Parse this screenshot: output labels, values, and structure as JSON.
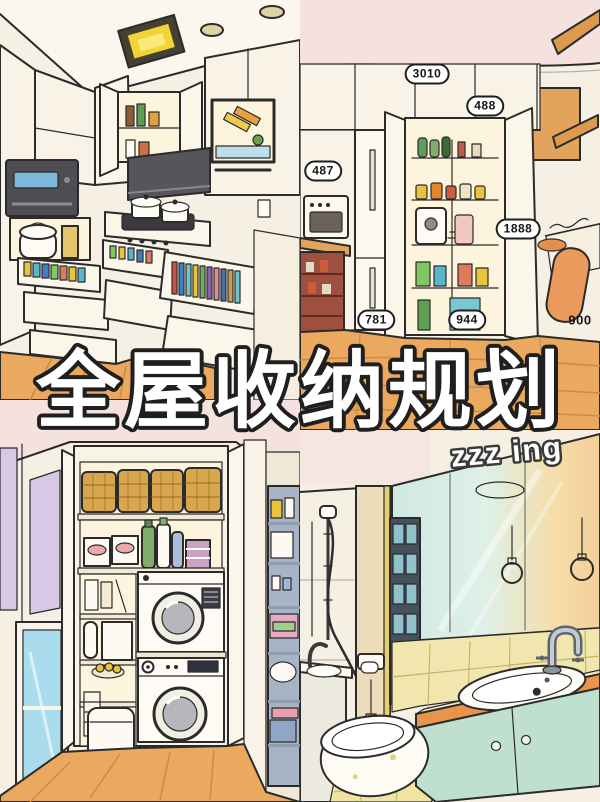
{
  "poster": {
    "title": "全屋收纳规划",
    "watermark": "zzz ing"
  },
  "dimensions": [
    {
      "name": "pantry-wall-width",
      "value": "3010"
    },
    {
      "name": "upper-cabinet-width",
      "value": "488"
    },
    {
      "name": "left-counter-width",
      "value": "487"
    },
    {
      "name": "pantry-cabinet-height",
      "value": "1888"
    },
    {
      "name": "floor-span-left",
      "value": "781"
    },
    {
      "name": "floor-span-center",
      "value": "944"
    },
    {
      "name": "walkway-depth",
      "value": "900"
    }
  ],
  "colors": {
    "ink": "#2b2b2b",
    "paper": "#f6efe3",
    "ceiling": "#fbf7ee",
    "pink": "#f5e2de",
    "wood": "#eaa95e",
    "wood-dark": "#c98b45",
    "cabinet": "#f8f3e6",
    "interior": "#fdf4dd",
    "appliance-dark": "#4e4e52",
    "hood": "#55555a",
    "mint": "#bfe0cf",
    "counter": "#e8944a",
    "tile": "#f1e6ae",
    "lavender": "#d9c7e6",
    "glass": "#a9dcec",
    "basket": "#d9a64e",
    "steel": "#c3ccd2",
    "label-bg": "#ffffff",
    "title-fill": "#ffffff"
  }
}
